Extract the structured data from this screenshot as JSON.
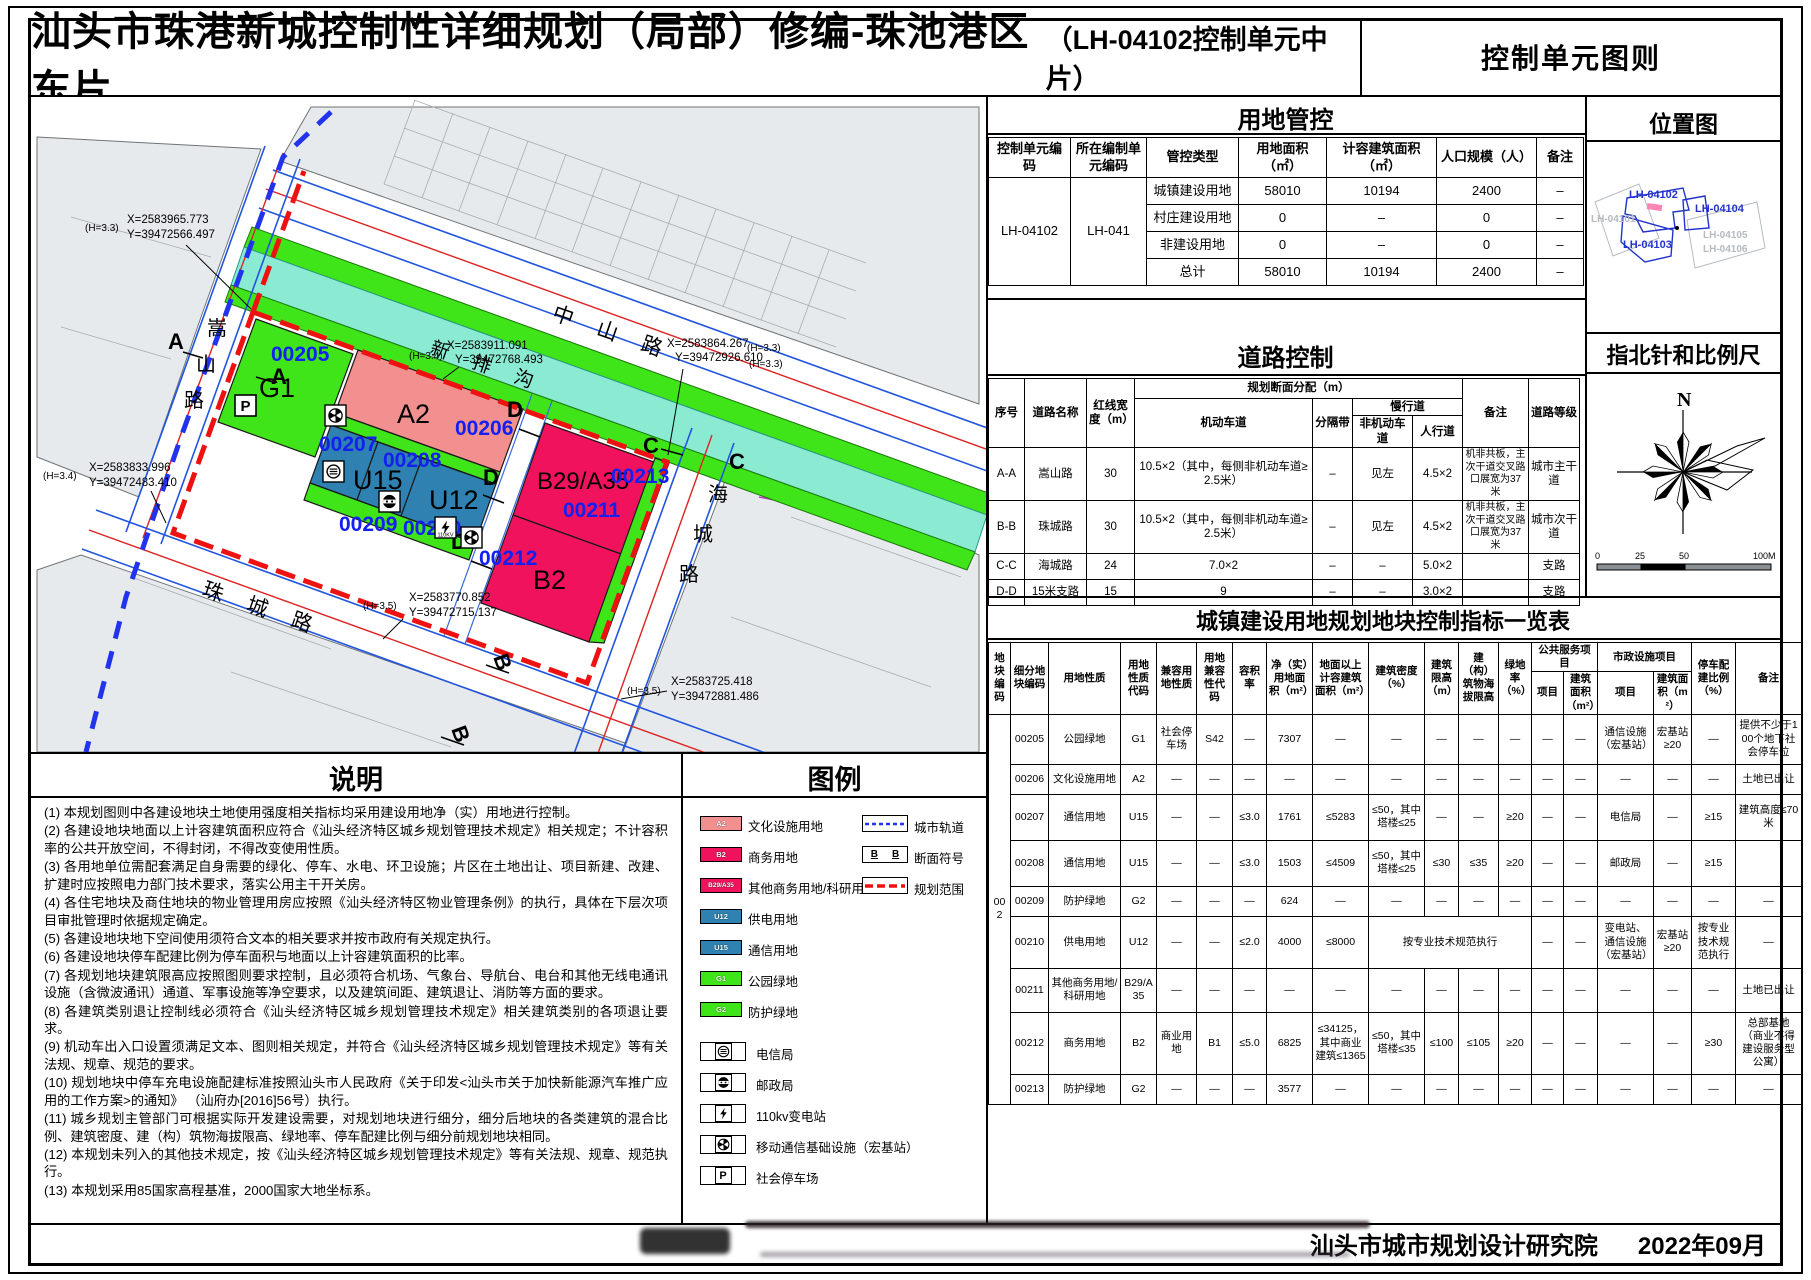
{
  "title": {
    "main": "汕头市珠港新城控制性详细规划（局部）修编-珠池港区东片",
    "sub": "（LH-04102控制单元中片）",
    "right": "控制单元图则"
  },
  "panels": {
    "landuse_control": "用地管控",
    "road_control": "道路控制",
    "plot_table": "城镇建设用地规划地块控制指标一览表",
    "location": "位置图",
    "compass": "指北针和比例尺",
    "notes": "说明",
    "legend": "图例"
  },
  "landuse_table": {
    "headers": [
      "控制单元编码",
      "所在编制单元编码",
      "管控类型",
      "用地面积（㎡）",
      "计容建筑面积（㎡）",
      "人口规模（人）",
      "备注"
    ],
    "unit_code": "LH-04102",
    "parent_code": "LH-041",
    "rows": [
      [
        "城镇建设用地",
        "58010",
        "10194",
        "2400",
        "–"
      ],
      [
        "村庄建设用地",
        "0",
        "–",
        "0",
        "–"
      ],
      [
        "非建设用地",
        "0",
        "–",
        "0",
        "–"
      ],
      [
        "总计",
        "58010",
        "10194",
        "2400",
        "–"
      ]
    ]
  },
  "road_table": {
    "headers": {
      "no": "序号",
      "name": "道路名称",
      "rl": "红线宽度（m）",
      "alloc": "规划断面分配（m）",
      "motor": "机动车道",
      "divider": "分隔带",
      "slow": "慢行道",
      "nonmotor": "非机动车道",
      "ped": "人行道",
      "remark": "备注",
      "grade": "道路等级"
    },
    "rows": [
      [
        "A-A",
        "嵩山路",
        "30",
        "10.5×2（其中，每侧非机动车道≥2.5米）",
        "–",
        "见左",
        "4.5×2",
        "机非共板，主次干道交叉路口展宽为37米",
        "城市主干道"
      ],
      [
        "B-B",
        "珠城路",
        "30",
        "10.5×2（其中，每侧非机动车道≥2.5米）",
        "–",
        "见左",
        "4.5×2",
        "机非共板，主次干道交叉路口展宽为37米",
        "城市次干道"
      ],
      [
        "C-C",
        "海城路",
        "24",
        "7.0×2",
        "–",
        "–",
        "5.0×2",
        "",
        "支路"
      ],
      [
        "D-D",
        "15米支路",
        "15",
        "9",
        "–",
        "–",
        "3.0×2",
        "",
        "支路"
      ]
    ]
  },
  "plot_table": {
    "block_code": "002",
    "headers": {
      "h1": "地块编码",
      "h2": "细分地块编码",
      "h3": "用地性质",
      "h4": "用地性质代码",
      "h5": "兼容用地性质",
      "h6": "用地兼容性代码",
      "h7": "容积率",
      "h8": "净（实）用地面积（m²）",
      "h9": "地面以上计容建筑面积（m²）",
      "h10": "建筑密度（%）",
      "h11": "建筑限高（m）",
      "h12": "建（构）筑物海拔限高",
      "h13": "绿地率（%）",
      "h14": "公共服务项目",
      "h15": "市政设施项目",
      "h16": "项目",
      "h17": "建筑面积（m²）",
      "h18": "项目",
      "h19": "建筑面积（m²）",
      "h20": "停车配建比例（%）",
      "h21": "备注"
    },
    "rows": {
      "r205": [
        "00205",
        "公园绿地",
        "G1",
        "社会停车场",
        "S42",
        "—",
        "7307",
        "—",
        "—",
        "—",
        "—",
        "—",
        "—",
        "—",
        "通信设施（宏基站）",
        "宏基站≥20",
        "—",
        "提供不少于100个地下社会停车位"
      ],
      "r206": [
        "00206",
        "文化设施用地",
        "A2",
        "—",
        "—",
        "—",
        "—",
        "—",
        "—",
        "—",
        "—",
        "—",
        "—",
        "—",
        "—",
        "—",
        "—",
        "土地已出让"
      ],
      "r207": [
        "00207",
        "通信用地",
        "U15",
        "—",
        "—",
        "≤3.0",
        "1761",
        "≤5283",
        "≤50，其中塔楼≤25",
        "—",
        "—",
        "≥20",
        "—",
        "—",
        "电信局",
        "—",
        "≥15",
        "建筑高度≤70米"
      ],
      "r208": [
        "00208",
        "通信用地",
        "U15",
        "—",
        "—",
        "≤3.0",
        "1503",
        "≤4509",
        "≤50，其中塔楼≤25",
        "≤30",
        "≤35",
        "≥20",
        "—",
        "—",
        "邮政局",
        "—",
        "≥15",
        ""
      ],
      "r209": [
        "00209",
        "防护绿地",
        "G2",
        "—",
        "—",
        "—",
        "624",
        "—",
        "—",
        "—",
        "—",
        "—",
        "—",
        "—",
        "—",
        "—",
        "—",
        "—"
      ],
      "r210": [
        "00210",
        "供电用地",
        "U12",
        "—",
        "—",
        "≤2.0",
        "4000",
        "≤8000",
        "按专业技术规范执行",
        "—",
        "—",
        "变电站、通信设施（宏基站）",
        "宏基站≥20",
        "按专业技术规范执行",
        "—"
      ],
      "r211": [
        "00211",
        "其他商务用地/科研用地",
        "B29/A35",
        "—",
        "—",
        "—",
        "—",
        "—",
        "—",
        "—",
        "—",
        "—",
        "—",
        "—",
        "—",
        "—",
        "—",
        "土地已出让"
      ],
      "r212": [
        "00212",
        "商务用地",
        "B2",
        "商业用地",
        "B1",
        "≤5.0",
        "6825",
        "≤34125，其中商业建筑≤1365",
        "≤50，其中塔楼≤35",
        "≤100",
        "≤105",
        "≥20",
        "—",
        "—",
        "—",
        "—",
        "≥30",
        "总部基地（商业不得建设服务型公寓）"
      ],
      "r213": [
        "00213",
        "防护绿地",
        "G2",
        "—",
        "—",
        "—",
        "3577",
        "—",
        "—",
        "—",
        "—",
        "—",
        "—",
        "—",
        "—",
        "—",
        "—",
        "—"
      ]
    }
  },
  "notes": [
    "(1) 本规划图则中各建设地块土地使用强度相关指标均采用建设用地净（实）用地进行控制。",
    "(2) 各建设地块地面以上计容建筑面积应符合《汕头经济特区城乡规划管理技术规定》相关规定；不计容积率的公共开放空间，不得封闭，不得改变使用性质。",
    "(3) 各用地单位需配套满足自身需要的绿化、停车、水电、环卫设施；片区在土地出让、项目新建、改建、扩建时应按照电力部门技术要求，落实公用主干开关房。",
    "(4) 各住宅地块及商住地块的物业管理用房应按照《汕头经济特区物业管理条例》的执行，具体在下层次项目审批管理时依据规定确定。",
    "(5) 各建设地块地下空间使用须符合文本的相关要求并按市政府有关规定执行。",
    "(6) 各建设地块停车配建比例为停车面积与地面以上计容建筑面积的比率。",
    "(7) 各规划地块建筑限高应按照图则要求控制，且必须符合机场、气象台、导航台、电台和其他无线电通讯设施（含微波通讯）通道、军事设施等净空要求，以及建筑间距、建筑退让、消防等方面的要求。",
    "(8) 各建筑类别退让控制线必须符合《汕头经济特区城乡规划管理技术规定》相关建筑类别的各项退让要求。",
    "(9) 机动车出入口设置须满足文本、图则相关规定，并符合《汕头经济特区城乡规划管理技术规定》等有关法规、规章、规范的要求。",
    "(10) 规划地块中停车充电设施配建标准按照汕头市人民政府《关于印发<汕头市关于加快新能源汽车推广应用的工作方案>的通知》 （汕府办[2016]56号）执行。",
    "(11) 城乡规划主管部门可根据实际开发建设需要，对规划地块进行细分，细分后地块的各类建筑的混合比例、建筑密度、建（构）筑物海拔限高、绿地率、停车配建比例与细分前规划地块相同。",
    "(12) 本规划未列入的其他技术规定，按《汕头经济特区城乡规划管理技术规定》等有关法规、规章、规范执行。",
    "(13) 本规划采用85国家高程基准，2000国家大地坐标系。"
  ],
  "legend": {
    "landuse": [
      {
        "code": "A2",
        "label": "文化设施用地",
        "color": "#F29090"
      },
      {
        "code": "B2",
        "label": "商务用地",
        "color": "#F1125E"
      },
      {
        "code": "B29/A35",
        "label": "其他商务用地/科研用地",
        "color": "#F1125E"
      },
      {
        "code": "U12",
        "label": "供电用地",
        "color": "#2E81B1"
      },
      {
        "code": "U15",
        "label": "通信用地",
        "color": "#2E81B1"
      },
      {
        "code": "G1",
        "label": "公园绿地",
        "color": "#3FE519"
      },
      {
        "code": "G2",
        "label": "防护绿地",
        "color": "#3FE519"
      }
    ],
    "lines": [
      {
        "label": "城市轨道"
      },
      {
        "label": "断面符号"
      },
      {
        "label": "规划范围"
      }
    ],
    "facilities": [
      {
        "label": "电信局"
      },
      {
        "label": "邮政局"
      },
      {
        "label": "110kv变电站"
      },
      {
        "label": "移动通信基础设施（宏基站）"
      },
      {
        "label": "社会停车场"
      }
    ]
  },
  "icons": {
    "parking_letter": "P",
    "kv_label": "110KV"
  },
  "map": {
    "road_names": {
      "zhongshan": "中 山 路",
      "xinpaigou": "新 排 沟",
      "zhucheng": "珠 城 路",
      "songshan1": "嵩",
      "songshan2": "山",
      "songshan3": "路",
      "haicheng1": "海",
      "haicheng2": "城",
      "haicheng3": "路"
    },
    "blocks": {
      "g1": "G1",
      "a2": "A2",
      "u15": "U15",
      "u12": "U12",
      "b29": "B29/A35",
      "b2": "B2"
    },
    "codes": {
      "c205": "00205",
      "c206": "00206",
      "c207": "00207",
      "c208": "00208",
      "c209": "00209",
      "c210": "00210",
      "c211": "00211",
      "c212": "00212",
      "c213": "00213"
    },
    "sections": {
      "a": "A",
      "b": "B",
      "c": "C",
      "d": "D"
    },
    "coords": [
      {
        "x": "X=2583965.773",
        "y": "Y=39472566.497",
        "h": "(H=3.3)"
      },
      {
        "x": "X=2583911.091",
        "y": "Y=39472768.493",
        "h": "(H=3.4)"
      },
      {
        "x": "X=2583864.267",
        "y": "Y=39472926.610",
        "h": "(H=3.3)"
      },
      {
        "x": "X=2583833.996",
        "y": "Y=39472483.410",
        "h": "(H=3.4)"
      },
      {
        "x": "X=2583770.852",
        "y": "Y=39472715.137",
        "h": "(H=3.5)"
      },
      {
        "x": "X=2583725.418",
        "y": "Y=39472881.486",
        "h": "(H=3.5)"
      }
    ],
    "north": "N",
    "scale_ticks": [
      "0",
      "25",
      "50",
      "100M"
    ]
  },
  "location_map": {
    "units": [
      "LH-04101",
      "LH-04102",
      "LH-04103",
      "LH-04104",
      "LH-04105",
      "LH-04106"
    ]
  },
  "footer": {
    "org": "汕头市城市规划设计研究院",
    "date": "2022年09月"
  }
}
